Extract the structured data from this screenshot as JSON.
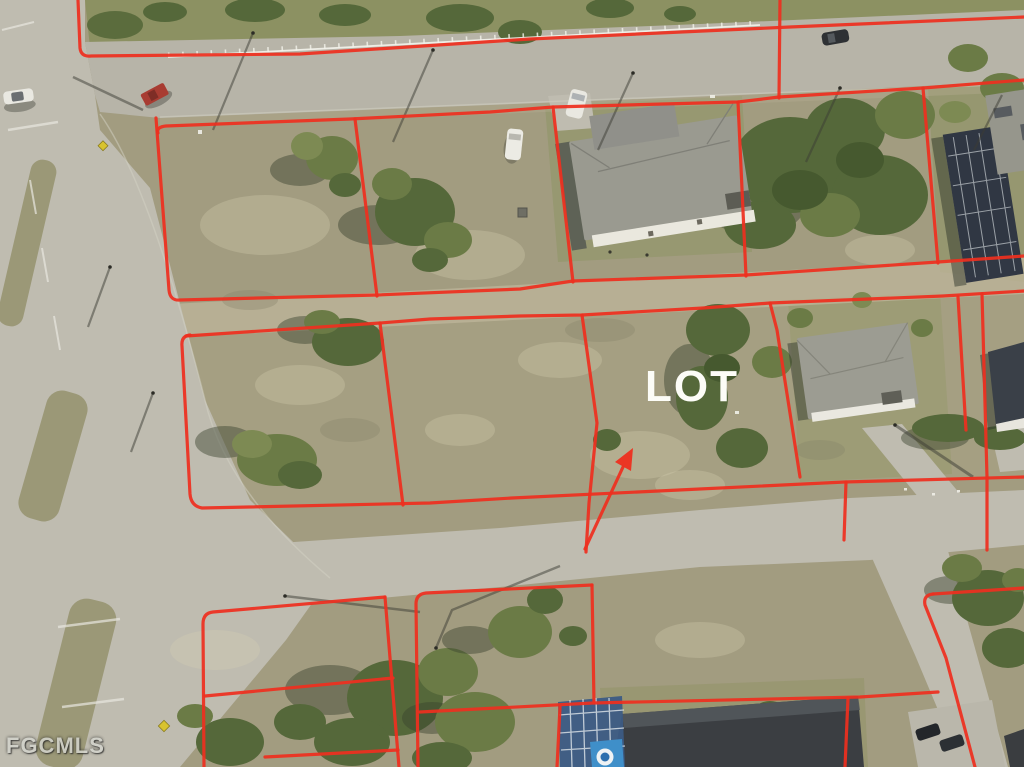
{
  "scene": {
    "type": "aerial-real-estate-listing-photo",
    "description": "Oblique aerial photo of a vacant residential corner block with red parcel boundary overlay"
  },
  "annotations": {
    "lot_label": "LOT",
    "watermark": "FGCMLS",
    "arrow": {
      "style": "red-annotation-arrow",
      "direction": "pointing-up-right-at-vacant-lot"
    }
  },
  "colors": {
    "boundary_red": "#ee2f1f",
    "lot_label": "#fcfcf7",
    "watermark": "#d4d4cd",
    "grass_base": "#a29c80",
    "grass_green": "#8c9162",
    "road": "#bfbcb0",
    "road_top": "#b7b4a8",
    "dirt_path": "#bdb499",
    "tree_canopy": "#6b7b46",
    "tree_dark": "#55683a",
    "tree_shadow": "#39422e",
    "roof_gray": "#9a9a90",
    "roof_dark": "#3b3e42",
    "pool_cage_blue": "#3c5b84",
    "pool_water": "#3f8fc9",
    "house_wall": "#e9e7dd",
    "fence_white": "#f2f2ea",
    "truck_red": "#a83c32"
  },
  "features": {
    "roads": [
      "top-road",
      "left-boulevard-with-medians",
      "middle-road",
      "southeast-street"
    ],
    "houses": [
      "single-family-house-north",
      "house-with-pool-cage-northeast",
      "single-family-house-east",
      "house-with-blue-pool-cage-south",
      "house-corner-southeast"
    ],
    "vehicles": [
      "white-car-west",
      "red-pickup-truck",
      "white-van-on-road",
      "white-van-parked",
      "dark-suv-top-road",
      "dark-car-1",
      "dark-car-2"
    ],
    "landmarks": [
      "white-rail-fence",
      "dirt-path",
      "power-pole-shadows",
      "yellow-diamond-sign-north",
      "yellow-diamond-sign-south"
    ]
  }
}
